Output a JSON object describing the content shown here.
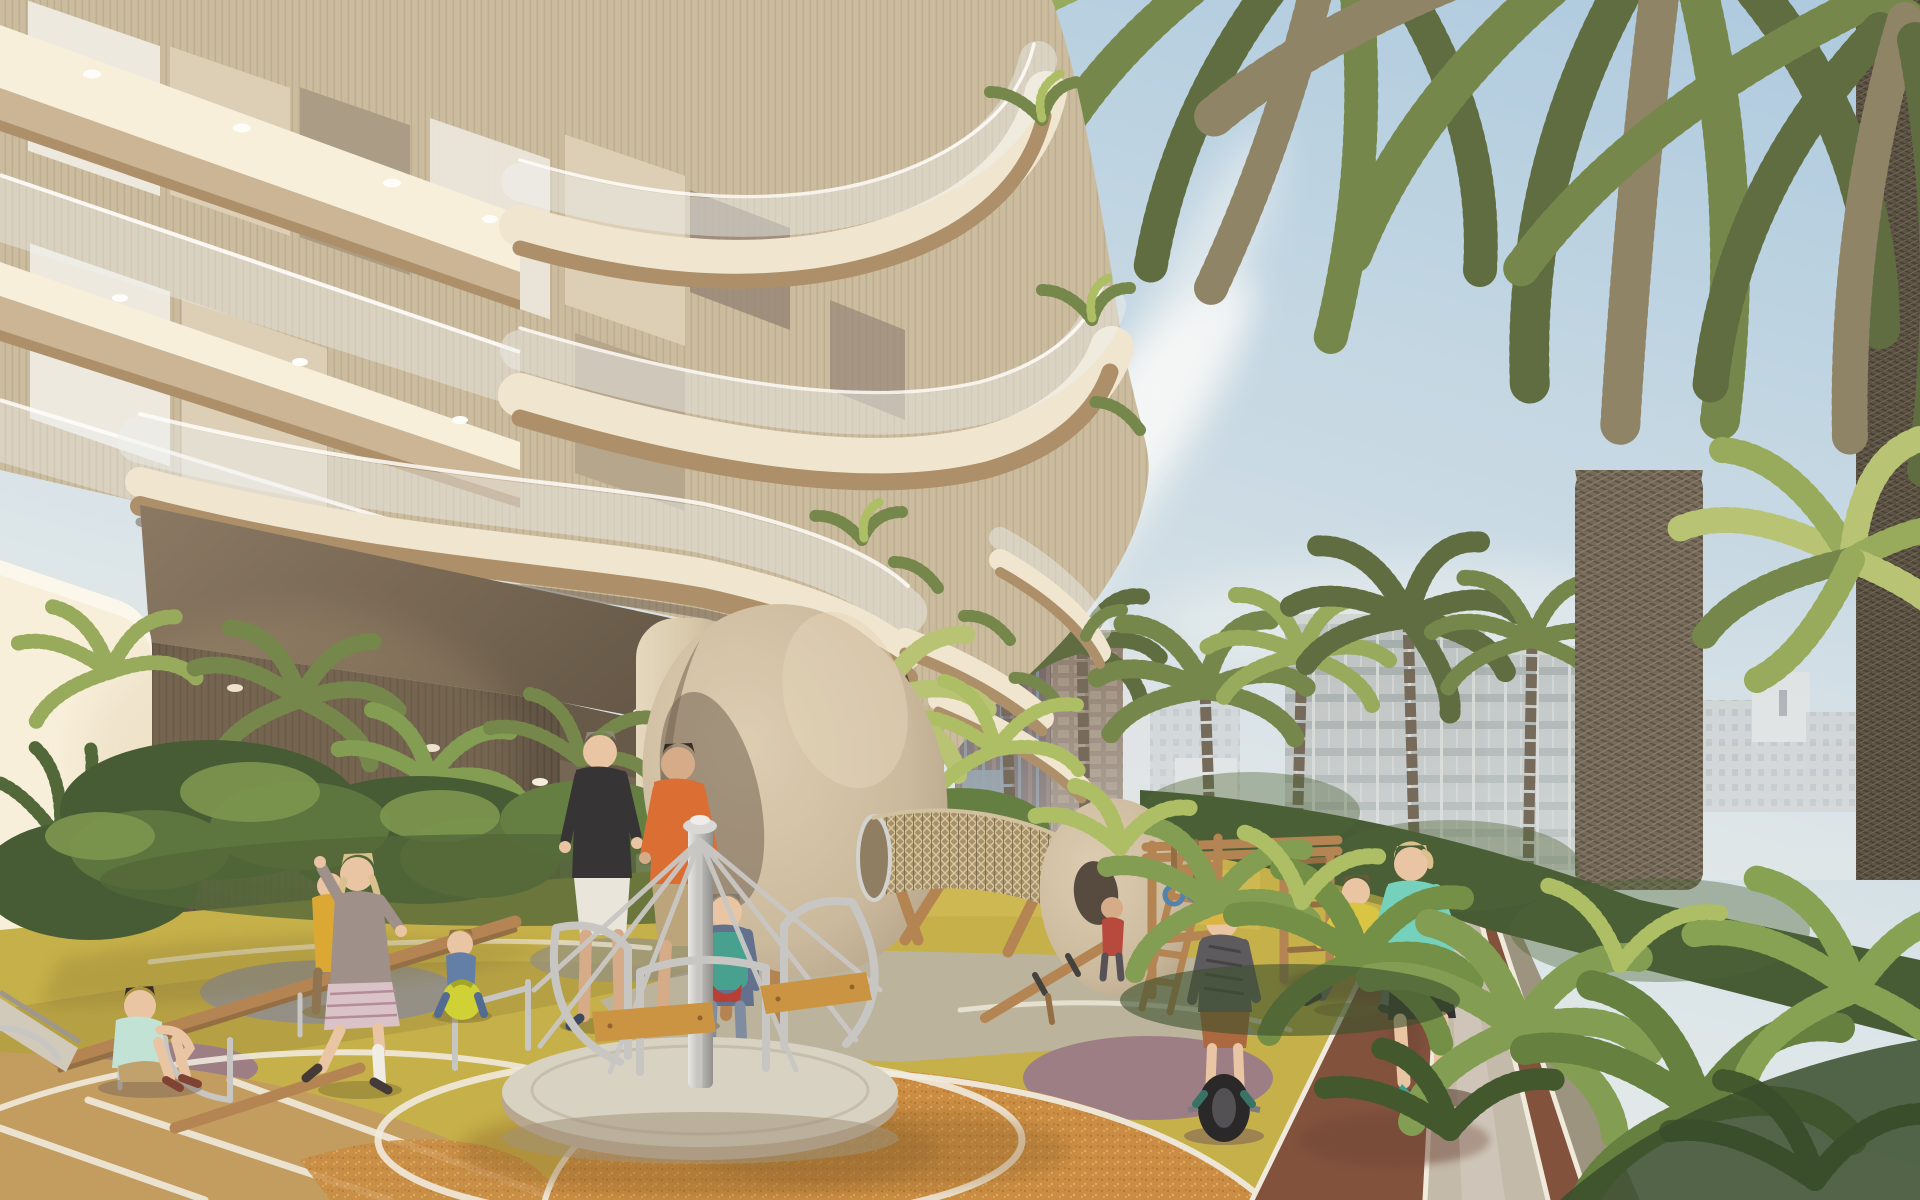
{
  "scene": {
    "title": "Architectural rendering: residential tower podium with children's playground, jogging track, palm trees and city skyline",
    "type": "photoreal-render",
    "lighting": "warm low sun from left, clear day",
    "regions": {
      "sky": "light blue sky with thin white cloud streaks, upper right",
      "building": "curved cream balcony slabs with glass balustrades, bronze fascias, ribbed beige walls, recessed soffit lights, double-height colonnade with round columns",
      "skyline": "hazy mid-rise city blocks on the horizon; one glassy grid facade building; two dark striped towers close behind the podium",
      "palms": "large date-palm canopy hanging over the top right, fat fibrous trunk and a second trunk at right edge; row of smaller palm crowns along the path",
      "playground": "olive-yellow, terracotta-orange and mauve rubber surface zones with white curved lane lines; merry-go-round, two egg-shaped climber pods joined by a rope-mesh tunnel, timber climbing frame, balance beams, small slide",
      "track": "red-brown jogging lane plus light walking lane converging to the horizon, white edge lines, planter hedge and tropical ferns to its right",
      "people": "eleven figures: jogger, playing children and two adults"
    },
    "people": [
      {
        "id": "jogger",
        "desc": "blond woman jogging toward camera",
        "top": "#6ed1bd",
        "shorts": "#26262e",
        "shoes": "#2f9f92",
        "pos": "track, center right"
      },
      {
        "id": "backpack-kid",
        "desc": "child walking away with teal backpack and red pouch",
        "jacket": "#5b6c8f",
        "backpack": "#3f9e8f",
        "pouch": "#b5372f",
        "pos": "beside merry-go-round"
      },
      {
        "id": "adult-black",
        "desc": "adult, black tee, white shorts",
        "top": "#2c2c30",
        "shorts": "#e9e6df",
        "pos": "center, under colonnade edge"
      },
      {
        "id": "adult-orange",
        "desc": "adult, orange long sleeve, khaki shorts",
        "top": "#d9692e",
        "shorts": "#b9a27a",
        "pos": "center"
      },
      {
        "id": "girl-running",
        "desc": "girl with blond pigtails, grey hoodie, plaid skirt, white legwarmer",
        "top": "#9a8d8a",
        "skirt": "#d9c2cb",
        "pos": "left playground"
      },
      {
        "id": "toddler-yellow",
        "desc": "toddler in mustard jacket",
        "top": "#d9a62e",
        "pos": "behind running girl"
      },
      {
        "id": "boy-sitting",
        "desc": "boy sitting on mauve patch, mint tee, khaki shorts",
        "top": "#bfe3d9",
        "shorts": "#bfa06a",
        "pos": "lower left"
      },
      {
        "id": "toddler-ball",
        "desc": "toddler in denim on yellow hopper ball",
        "outfit": "#5b7ba6",
        "ball": "#cdd12f",
        "pos": "left, at beam end"
      },
      {
        "id": "unicycle-kid",
        "desc": "kid with yellow helmet riding electric unicycle",
        "shirt": "#56555b",
        "shorts": "#a8643a",
        "helmet": "#d9b43f",
        "wheel": "#1f1f22",
        "pos": "mauve patch right of playground"
      },
      {
        "id": "boy-yellow-run",
        "desc": "boy in yellow tee leaping",
        "top": "#d9c33f",
        "pants": "#5a5f66",
        "pos": "by climbing frame"
      },
      {
        "id": "kid-red",
        "desc": "small child in red shirt at seesaw end",
        "top": "#b54238",
        "pos": "center right of eggs"
      }
    ],
    "equipment": [
      {
        "id": "merry-go-round",
        "desc": "steel carousel with curved handrail loops, timber bench seats, round grey platform",
        "x": 505,
        "y": 820,
        "w": 400,
        "h": 350
      },
      {
        "id": "egg-pod-large",
        "desc": "large tilted egg-shell climber",
        "x": 645,
        "y": 600,
        "w": 300,
        "h": 380
      },
      {
        "id": "egg-pod-small",
        "desc": "small egg climber with leaning timber ladder",
        "x": 1042,
        "y": 798,
        "w": 160,
        "h": 210
      },
      {
        "id": "net-tunnel",
        "desc": "rope-mesh crawl tunnel joining the egg pods",
        "x": 875,
        "y": 815,
        "w": 200,
        "h": 110
      },
      {
        "id": "climbing-frame",
        "desc": "timber frame with monkey bars, rings and ladder",
        "x": 1145,
        "y": 835,
        "w": 195,
        "h": 160
      },
      {
        "id": "balance-beam",
        "desc": "timber balance beam / seesaw planks",
        "x": 40,
        "y": 900,
        "w": 1090,
        "h": 140
      },
      {
        "id": "slide",
        "desc": "small metal slide entering from left edge",
        "x": 0,
        "y": 995,
        "w": 80,
        "h": 85
      }
    ],
    "ground_zones": [
      {
        "id": "olive",
        "color": "#c3ae45"
      },
      {
        "id": "orange",
        "color": "#c98a3f"
      },
      {
        "id": "tan-striped",
        "color": "#bf9a5c"
      },
      {
        "id": "mauve",
        "color": "#987a83"
      },
      {
        "id": "gravel",
        "color": "#8f8d85"
      },
      {
        "id": "concrete",
        "color": "#b8b2a5"
      },
      {
        "id": "track-red",
        "color": "#7c4b38"
      },
      {
        "id": "walk-lane",
        "color": "#c1b9ab"
      }
    ]
  },
  "palette": {
    "--sky-top": "#a9c9e2",
    "--sky-mid": "#cfdfe9",
    "--sky-horizon": "#ecf0f1",
    "--cloud": "#f8fbfc",
    "--city": "#c5ccd2",
    "--city-light": "#dde2e6",
    "--city-win": "#a9b3bb",
    "--haze": "#e9edf0",
    "--glassbldg": "#b4bdbf",
    "--glassbldg-win": "#97a3a5",
    "--tower-dark": "#584a4e",
    "--tower-stripe": "#6f5c55",
    "--tower-glass": "#70879b",
    "--tower-brown": "#7d6a5b",
    "--cream": "#f0e7d3",
    "--cream-bright": "#f8f1de",
    "--tan": "#c9b494",
    "--bronze": "#a98d68",
    "--soffit": "#786952",
    "--walldark": "#5a4e40",
    "--wallmid": "#70634f",
    "--rib": "#cabb9f",
    "--curtain": "#dbcfb8",
    "--sheer": "#eceae2",
    "--glass": "#eef2f4",
    "--column": "#e4d8c0",
    "--colshade": "#b7a88d",
    "--palm-dark": "#57683c",
    "--palm-mid": "#6f8347",
    "--palm-light": "#93a858",
    "--palm-sun": "#b5c272",
    "--dry": "#8b8065",
    "--trunk": "#6f6557",
    "--trunk-dark": "#544c40",
    "--shrub": "#3e5530",
    "--fern": "#4a6233",
    "--fan": "#7d9a4e",
    "--leaf-sun": "#a9bd62",
    "--olive": "#c3ae45",
    "--olive-shade": "#a6923c",
    "--orange": "#c98a3f",
    "--orange-lit": "#dba557",
    "--tanground": "#bf9a5c",
    "--mauve": "#987a83",
    "--gravel": "#8f8d85",
    "--concrete": "#b8b2a5",
    "--white-line": "#efebe0",
    "--track": "#7c4b38",
    "--track-shade": "#693f30",
    "--lane": "#c1b9ab",
    "--curb": "#97917e",
    "--steel": "#c6c6c6",
    "--steel-dark": "#9a9a9a",
    "--wood": "#b08050",
    "--wood-dark": "#8f6a3f",
    "--egg": "#c9b89d",
    "--egg-shade": "#a2917a",
    "--mesh": "#a28e69",
    "--skin": "#e8c4a4",
    "--skin-shade": "#d3a987",
    "--hair-blond": "#d9bf8d",
    "--jog-top": "#6ed1bd",
    "--jog-shorts": "#26262e",
    "--jog-shoe": "#2f9f92"
  }
}
